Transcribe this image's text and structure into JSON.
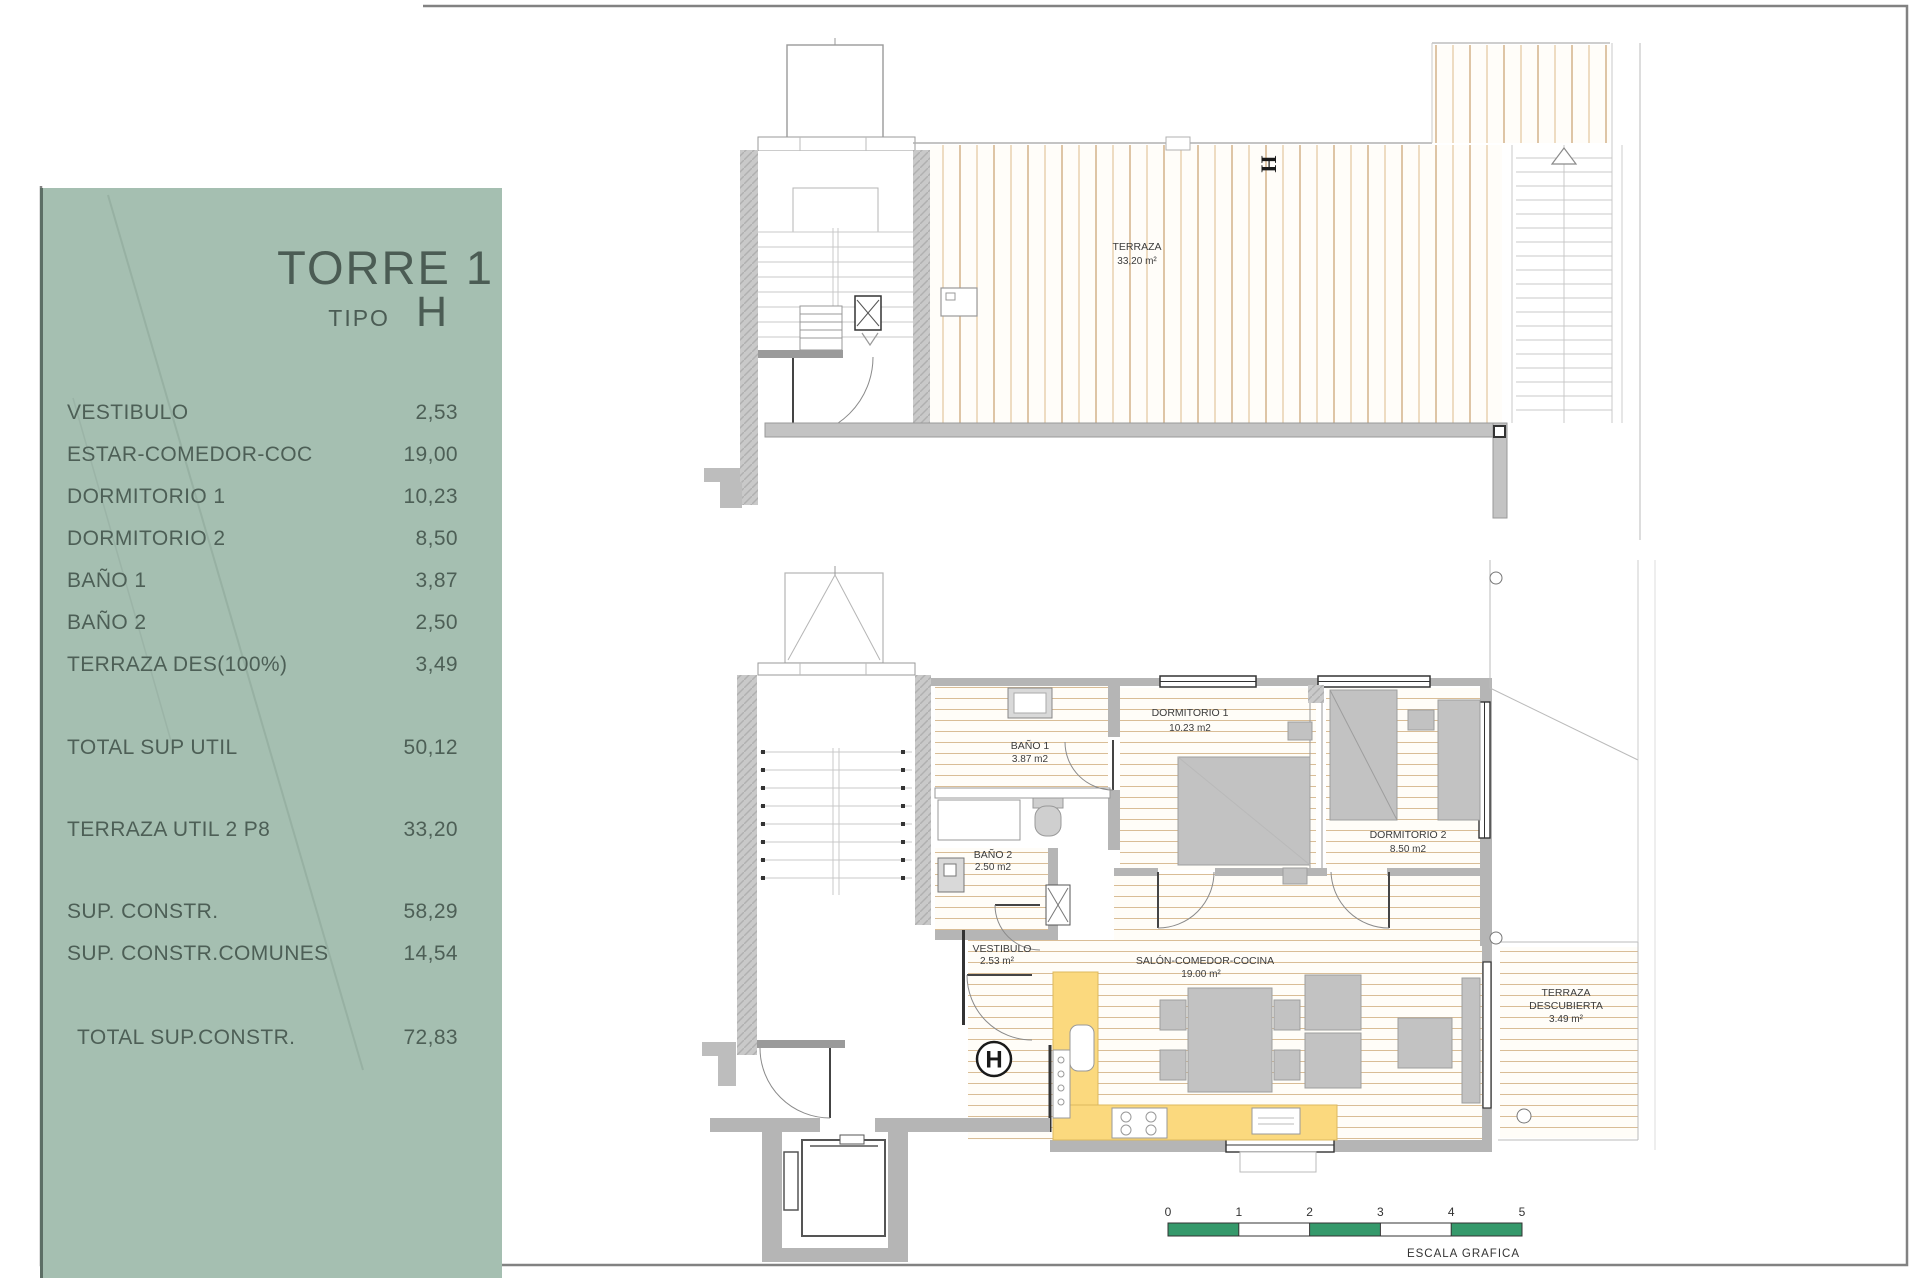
{
  "sidebar": {
    "panel_color": "#a5bfb1",
    "title": "TORRE 1",
    "tipo_label": "TIPO",
    "tipo_value": "H",
    "rows": [
      {
        "label": "VESTIBULO",
        "value": "2,53"
      },
      {
        "label": "ESTAR-COMEDOR-COC",
        "value": "19,00"
      },
      {
        "label": "DORMITORIO 1",
        "value": "10,23"
      },
      {
        "label": "DORMITORIO 2",
        "value": "8,50"
      },
      {
        "label": "BAÑO 1",
        "value": "3,87"
      },
      {
        "label": "BAÑO 2",
        "value": "2,50"
      },
      {
        "label": "TERRAZA DES(100%)",
        "value": "3,49"
      }
    ],
    "total_util": {
      "label": "TOTAL SUP UTIL",
      "value": "50,12"
    },
    "terraza_util": {
      "label": "TERRAZA UTIL 2 P8",
      "value": "33,20"
    },
    "constr_rows": [
      {
        "label": "SUP. CONSTR.",
        "value": "58,29"
      },
      {
        "label": "SUP. CONSTR.COMUNES",
        "value": "14,54"
      }
    ],
    "total_constr": {
      "label": "TOTAL SUP.CONSTR.",
      "value": "72,83"
    }
  },
  "upper_plan": {
    "section_mark": "H",
    "terrace": {
      "name": "TERRAZA",
      "area": "33,20 m²"
    }
  },
  "lower_plan": {
    "section_mark": "H",
    "rooms": [
      {
        "name": "DORMITORIO 1",
        "area": "10.23 m2"
      },
      {
        "name": "DORMITORIO 2",
        "area": "8.50 m2"
      },
      {
        "name": "BAÑO 1",
        "area": "3.87 m2"
      },
      {
        "name": "BAÑO 2",
        "area": "2.50 m2"
      },
      {
        "name": "VESTIBULO",
        "area": "2.53 m²"
      },
      {
        "name": "SALÓN-COMEDOR-COCINA",
        "area": "19.00 m²"
      },
      {
        "name": "TERRAZA DESCUBIERTA",
        "name_line1": "TERRAZA",
        "name_line2": "DESCUBIERTA",
        "area": "3.49 m²"
      }
    ]
  },
  "scale_bar": {
    "ticks": [
      "0",
      "1",
      "2",
      "3",
      "4",
      "5"
    ],
    "label": "ESCALA GRAFICA",
    "color": "#35996b"
  }
}
